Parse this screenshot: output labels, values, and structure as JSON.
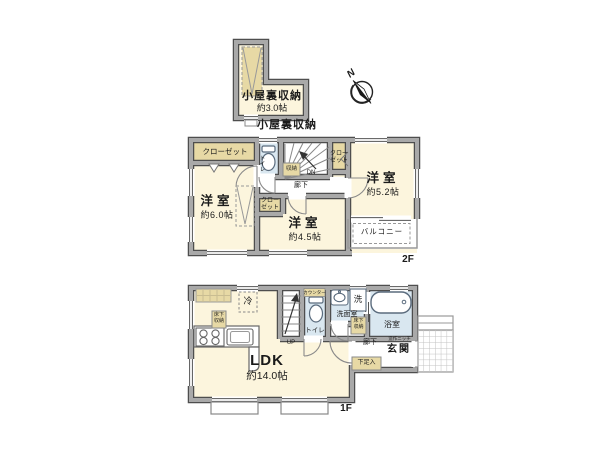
{
  "attic": {
    "name": "小屋裏収納",
    "size": "約3.0帖",
    "caption": "小屋裏収納"
  },
  "compass": {
    "north": "N"
  },
  "floor2": {
    "label": "2F",
    "closet_top_left": "クローゼット",
    "closet_top_right": "クローゼット",
    "closet_middle": "クローゼット",
    "toilet": "トイレ",
    "storage": "収納",
    "stairs_down": "DN",
    "hallway": "廊下",
    "bedroom_left": {
      "name": "洋室",
      "size": "約6.0帖"
    },
    "bedroom_right": {
      "name": "洋室",
      "size": "約5.2帖"
    },
    "bedroom_center": {
      "name": "洋室",
      "size": "約4.5帖"
    },
    "balcony": "バルコニー"
  },
  "floor1": {
    "label": "1F",
    "ldk": {
      "name": "LDK",
      "size": "約14.0帖"
    },
    "refrigerator": "冷",
    "underfloor_storage_kitchen": "床下収納",
    "underfloor_storage_hall": "床下収納",
    "stairs_up": "UP",
    "toilet_counter": "カウンター",
    "toilet": "トイレ",
    "washroom": "洗面室",
    "washer": "洗",
    "bathroom": "浴室",
    "hallway": "廊下",
    "niche": "造作ニッチ",
    "entrance": "玄関",
    "shoe_cabinet": "下足入"
  },
  "colors": {
    "wall_fill": "#a9a9a9",
    "wall_edge": "#4e4e4e",
    "room": "#fcf5dd",
    "closet": "#e7d9a5",
    "water": "#d9e7f0",
    "line": "#777777"
  }
}
